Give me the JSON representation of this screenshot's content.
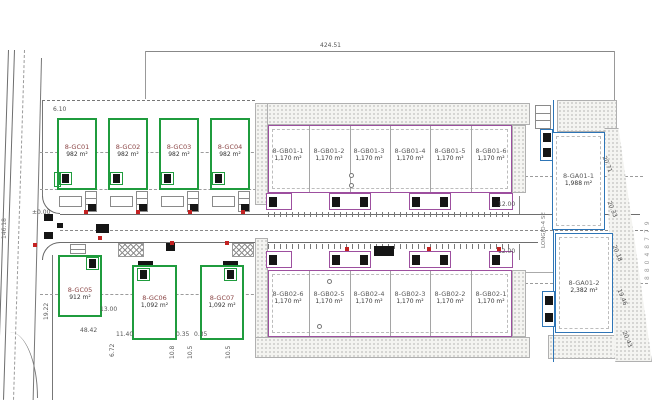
{
  "colors": {
    "green": "#1f9c3d",
    "purple": "#9d4f9f",
    "blue": "#2e75b6",
    "red": "#c32222"
  },
  "units": {
    "gc_top": [
      {
        "name": "8-GC01",
        "area": "982 m²"
      },
      {
        "name": "8-GC02",
        "area": "982 m²"
      },
      {
        "name": "8-GC03",
        "area": "982 m²"
      },
      {
        "name": "8-GC04",
        "area": "982 m²"
      }
    ],
    "gb01": [
      {
        "name": "8-GB01-1",
        "area": "1,170 m²"
      },
      {
        "name": "8-GB01-2",
        "area": "1,170 m²"
      },
      {
        "name": "8-GB01-3",
        "area": "1,170 m²"
      },
      {
        "name": "8-GB01-4",
        "area": "1,170 m²"
      },
      {
        "name": "8-GB01-5",
        "area": "1,170 m²"
      },
      {
        "name": "8-GB01-6",
        "area": "1,170 m²"
      }
    ],
    "gb02": [
      {
        "name": "8-GB02-6",
        "area": "1,170 m²"
      },
      {
        "name": "8-GB02-5",
        "area": "1,170 m²"
      },
      {
        "name": "8-GB02-4",
        "area": "1,170 m²"
      },
      {
        "name": "8-GB02-3",
        "area": "1,170 m²"
      },
      {
        "name": "8-GB02-2",
        "area": "1,170 m²"
      },
      {
        "name": "8-GB02-1",
        "area": "1,170 m²"
      }
    ],
    "ga": [
      {
        "name": "8-GA01-1",
        "area": "1,988 m²"
      },
      {
        "name": "8-GA01-2",
        "area": "2,382 m²"
      }
    ],
    "gc_bottom": [
      {
        "name": "8-GC05",
        "area": "912 m²"
      },
      {
        "name": "8-GC06",
        "area": "1,092 m²"
      },
      {
        "name": "8-GC07",
        "area": "1,092 m²"
      }
    ]
  },
  "dims": {
    "top_width": "424.51",
    "level": "±0.00",
    "road_w1": "12.00",
    "road_w2": "12.00",
    "w_6_10": "6.10",
    "w_48_42": "48.42",
    "w_13_00": "13.00",
    "w_11_40": "11.40",
    "w_0_35a": "0.35",
    "w_0_35b": "0.35",
    "v_19_22": "19.22",
    "v_6_72": "6.72",
    "v_10_8": "10.8",
    "v_10_5a": "10.5",
    "v_10_5b": "10.5",
    "v_146_18": "146.18"
  },
  "boundary_dims": [
    "20.71",
    "20.33",
    "20.18",
    "19.46",
    "20.43"
  ],
  "neighbor_label": "88048779",
  "side_label": "LONGJO-4 SE"
}
